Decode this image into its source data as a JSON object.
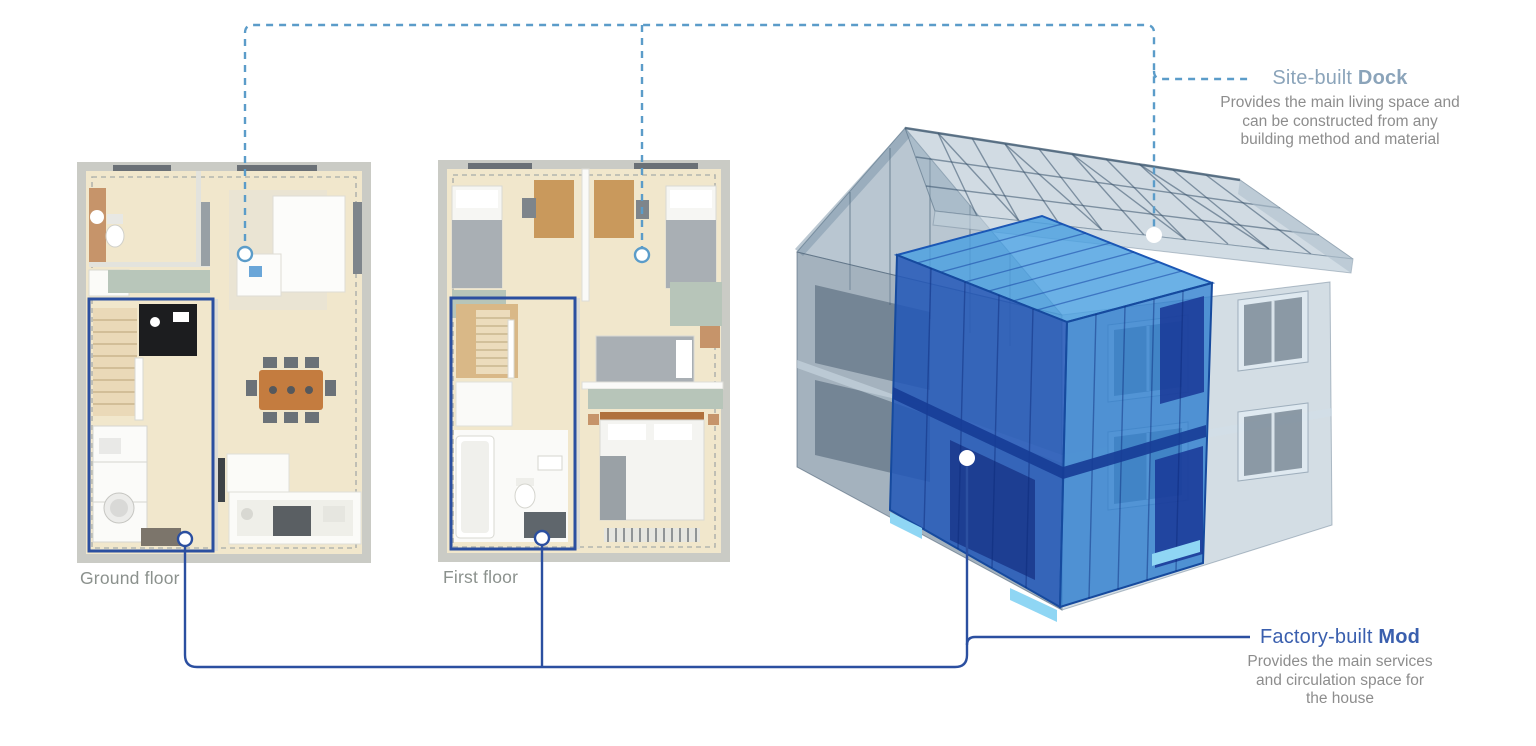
{
  "annotations": {
    "site_built": {
      "label_prefix": "Site-built ",
      "label_bold": "Dock",
      "desc_lines": [
        "Provides the main living space and",
        "can be constructed from any",
        "building method and material"
      ]
    },
    "factory_built": {
      "label_prefix": "Factory-built ",
      "label_bold": "Mod",
      "desc_lines": [
        "Provides the main services",
        "and circulation space for",
        "the house"
      ]
    }
  },
  "floor_plans": {
    "ground": {
      "label": "Ground floor"
    },
    "first": {
      "label": "First floor"
    }
  },
  "colors": {
    "dashed_blue": "#5b9cc9",
    "solid_blue": "#2b4fa0",
    "site_heading": "#8ba4ba",
    "factory_heading": "#3a5fae",
    "desc_gray": "#8d8d8d",
    "label_gray": "#8b918d",
    "mod_top": "#4aa0e0",
    "mod_left": "#2257b8",
    "mod_right": "#2e7ece",
    "mod_pad": "#8fd6f4"
  }
}
